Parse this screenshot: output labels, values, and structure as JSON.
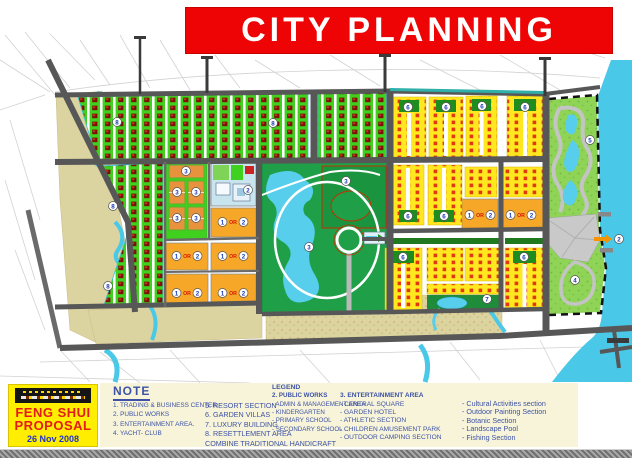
{
  "title": "CITY PLANNING",
  "proposal_box": {
    "line1": "FENG SHUI",
    "line2": "PROPOSAL",
    "date": "26 Nov 2008"
  },
  "note": {
    "heading": "NOTE",
    "col1": [
      "1. TRADING & BUSINESS CENTER.",
      "2. PUBLIC WORKS",
      "3. ENTERTAINMENT AREA.",
      "4. YACHT- CLUB"
    ],
    "col2": [
      "5. RESORT SECTION",
      "6. GARDEN VILLAS",
      "7. LUXURY BUILDING",
      "8. RESETTLEMENT AREA",
      "COMBINE TRADITIONAL HANDICRAFT"
    ]
  },
  "legend": {
    "heading": "LEGEND",
    "public_works": {
      "title": "2. PUBLIC WORKS",
      "items": [
        "- ADMIN & MANAGEMENT AREA",
        "- KINDERGARTEN",
        "- PRIMARY SCHOOL",
        "- SECONDARY SCHOOL"
      ]
    },
    "entertainment": {
      "title": "3. ENTERTAINMENT AREA",
      "items": [
        "- CENTRAL SQUARE",
        "- GARDEN HOTEL",
        "- ATHLETIC SECTION",
        "- CHILDREN AMUSEMENT PARK",
        "- OUTDOOR CAMPING SECTION"
      ]
    },
    "sections": {
      "items": [
        "- Cultural Activities section",
        "- Outdoor Painting Section",
        "- Botanic Section",
        "- Landscape Pool",
        "- Fishing Section"
      ]
    }
  },
  "map": {
    "labels": [
      {
        "k": "circle",
        "t": "8",
        "x": 117,
        "y": 122
      },
      {
        "k": "circle",
        "t": "8",
        "x": 273,
        "y": 123
      },
      {
        "k": "circle",
        "t": "8",
        "x": 113,
        "y": 206
      },
      {
        "k": "circle",
        "t": "8",
        "x": 108,
        "y": 286
      },
      {
        "k": "circle",
        "t": "6",
        "x": 408,
        "y": 107
      },
      {
        "k": "circle",
        "t": "6",
        "x": 446,
        "y": 107
      },
      {
        "k": "circle",
        "t": "6",
        "x": 482,
        "y": 106
      },
      {
        "k": "circle",
        "t": "6",
        "x": 525,
        "y": 107
      },
      {
        "k": "circle",
        "t": "6",
        "x": 408,
        "y": 216
      },
      {
        "k": "circle",
        "t": "6",
        "x": 444,
        "y": 216
      },
      {
        "k": "circle",
        "t": "6",
        "x": 403,
        "y": 257
      },
      {
        "k": "circle",
        "t": "6",
        "x": 524,
        "y": 257
      },
      {
        "k": "circle",
        "t": "7",
        "x": 487,
        "y": 299
      },
      {
        "k": "circle",
        "t": "3",
        "x": 346,
        "y": 181
      },
      {
        "k": "circle",
        "t": "3",
        "x": 309,
        "y": 247
      },
      {
        "k": "circle",
        "t": "3",
        "x": 186,
        "y": 171
      },
      {
        "k": "circle",
        "t": "3",
        "x": 177,
        "y": 192
      },
      {
        "k": "circle",
        "t": "3",
        "x": 196,
        "y": 192
      },
      {
        "k": "circle",
        "t": "3",
        "x": 177,
        "y": 218
      },
      {
        "k": "circle",
        "t": "3",
        "x": 196,
        "y": 218
      },
      {
        "k": "circle",
        "t": "2",
        "x": 248,
        "y": 190
      },
      {
        "k": "circle",
        "t": "5",
        "x": 590,
        "y": 140
      },
      {
        "k": "circle",
        "t": "4",
        "x": 575,
        "y": 280
      },
      {
        "k": "or",
        "a": "1",
        "b": "2",
        "x": 233,
        "y": 222
      },
      {
        "k": "or",
        "a": "1",
        "b": "2",
        "x": 187,
        "y": 256
      },
      {
        "k": "or",
        "a": "1",
        "b": "2",
        "x": 233,
        "y": 256
      },
      {
        "k": "or",
        "a": "1",
        "b": "2",
        "x": 187,
        "y": 293
      },
      {
        "k": "or",
        "a": "1",
        "b": "2",
        "x": 233,
        "y": 293
      },
      {
        "k": "or",
        "a": "1",
        "b": "2",
        "x": 480,
        "y": 215
      },
      {
        "k": "or",
        "a": "1",
        "b": "2",
        "x": 521,
        "y": 215
      },
      {
        "k": "arrow",
        "t": "2",
        "x": 610,
        "y": 239
      }
    ]
  },
  "colors": {
    "banner_red": "#ee0404",
    "house_green": "#3fd11e",
    "villa_yellow": "#ffe81f",
    "park_green": "#1fa048",
    "water_cyan": "#49c8e8",
    "orange_block": "#f6a728",
    "tan": "#dbd3a0",
    "note_blue": "#3d52a6",
    "proposal_yellow": "#ffee00"
  }
}
